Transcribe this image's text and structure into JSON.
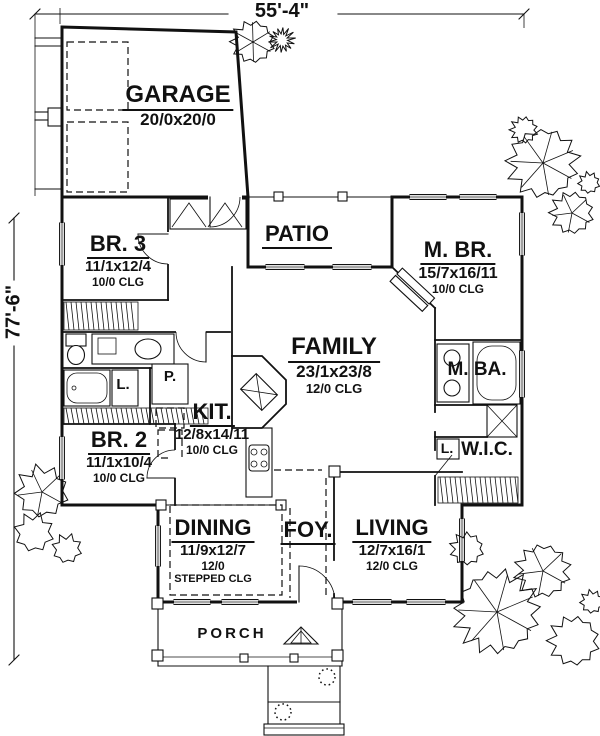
{
  "dimensions": {
    "width": "55'-4\"",
    "height": "77'-6\""
  },
  "rooms": {
    "garage": {
      "name": "GARAGE",
      "size": "20/0x20/0"
    },
    "patio": {
      "name": "PATIO"
    },
    "br3": {
      "name": "BR. 3",
      "size": "11/1x12/4",
      "clg": "10/0 CLG"
    },
    "mbr": {
      "name": "M. BR.",
      "size": "15/7x16/11",
      "clg": "10/0 CLG"
    },
    "family": {
      "name": "FAMILY",
      "size": "23/1x23/8",
      "clg": "12/0 CLG"
    },
    "mba": {
      "name": "M. BA."
    },
    "kit": {
      "name": "KIT.",
      "size": "12/8x14/11",
      "clg": "10/0 CLG"
    },
    "br2": {
      "name": "BR. 2",
      "size": "11/1x10/4",
      "clg": "10/0 CLG"
    },
    "wic": {
      "name": "W.I.C."
    },
    "linen_bath": {
      "name": "L."
    },
    "linen_wic": {
      "name": "L."
    },
    "pantry": {
      "name": "P."
    },
    "dining": {
      "name": "DINING",
      "size": "11/9x12/7",
      "clg": "12/0",
      "clg2": "STEPPED CLG"
    },
    "foy": {
      "name": "FOY."
    },
    "living": {
      "name": "LIVING",
      "size": "12/7x16/1",
      "clg": "12/0 CLG"
    },
    "porch": {
      "name": "PORCH"
    }
  },
  "colors": {
    "ink": "#111111",
    "paper": "#ffffff"
  }
}
